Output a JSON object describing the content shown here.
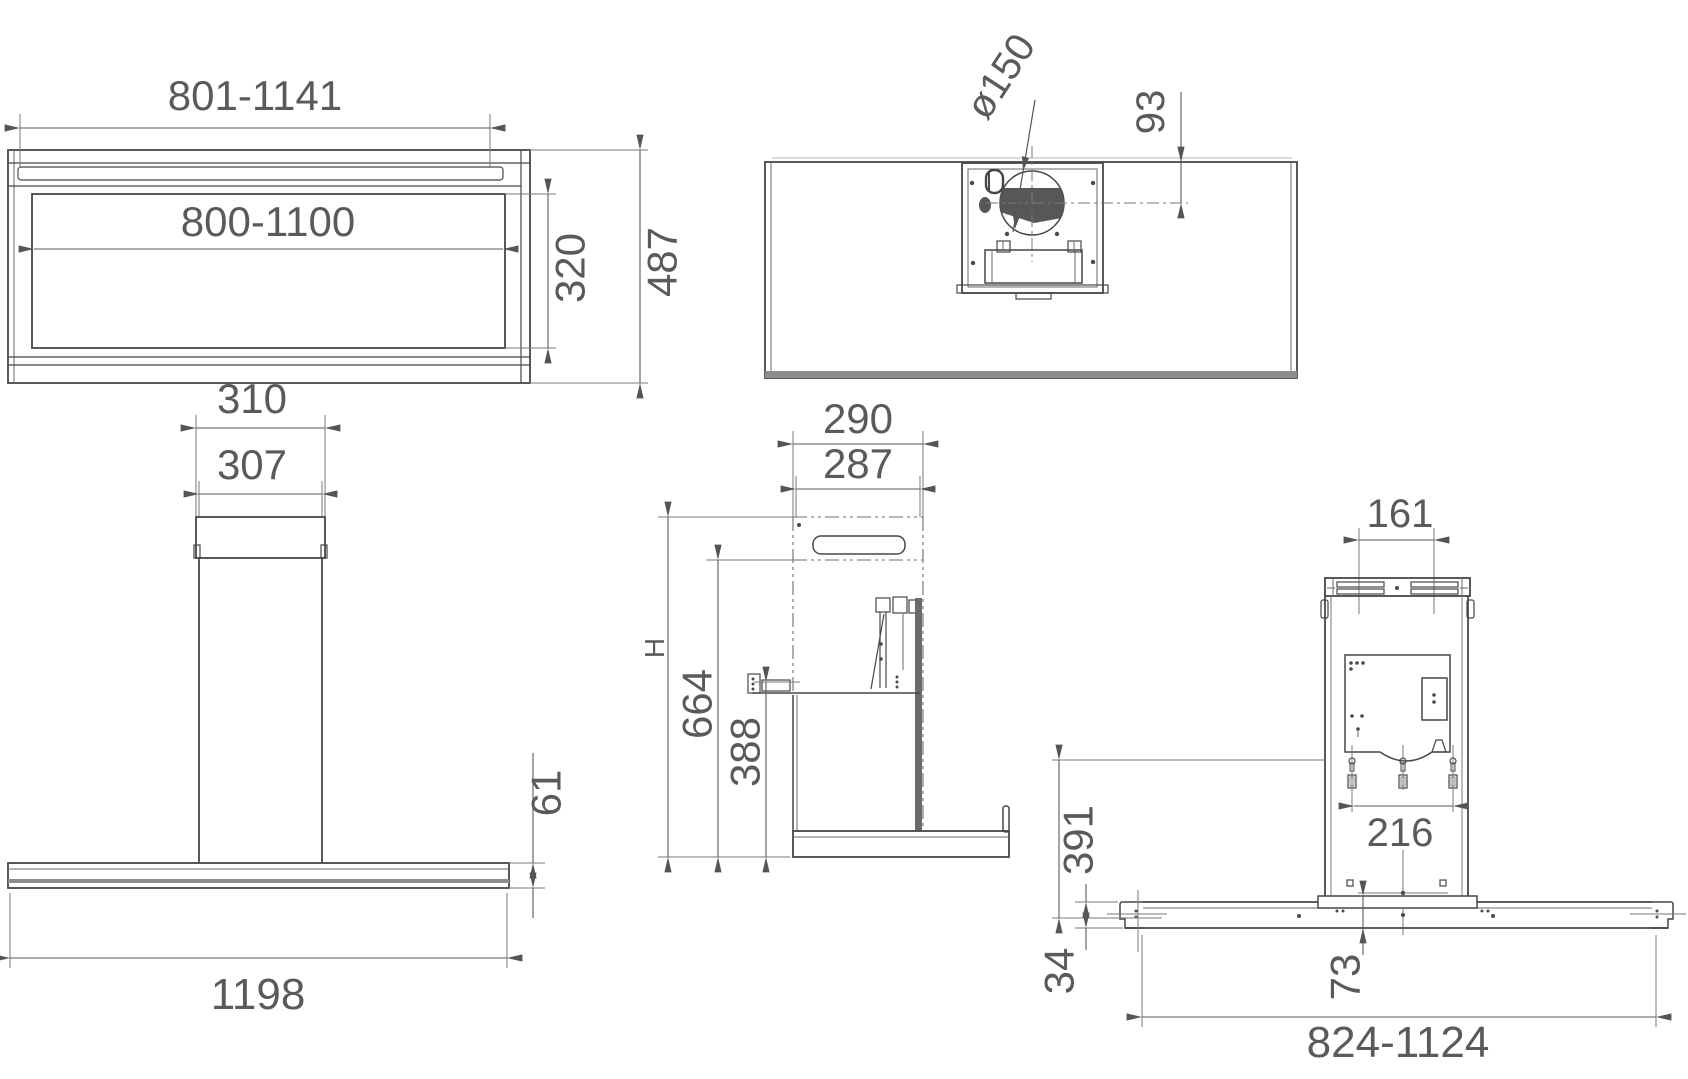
{
  "drawing": {
    "dimensions": {
      "hood_front": {
        "top_width": "801-1141",
        "glass_width": "800-1100",
        "glass_height": "320",
        "depth": "487"
      },
      "top_view": {
        "duct_diameter": "ø150",
        "duct_offset": "93"
      },
      "full_front": {
        "chimney_top_outer": "310",
        "chimney_top_inner": "307",
        "body_height": "61",
        "body_width": "1198"
      },
      "side_view": {
        "depth_outer": "290",
        "depth_inner": "287",
        "total_height": "H",
        "mid_height": "664",
        "lower_height": "388"
      },
      "rear_view": {
        "slot_spacing": "161",
        "keyhole_spacing": "216",
        "bracket_height": "391",
        "edge_height": "34",
        "center_height": "73",
        "base_width": "824-1124"
      }
    }
  }
}
